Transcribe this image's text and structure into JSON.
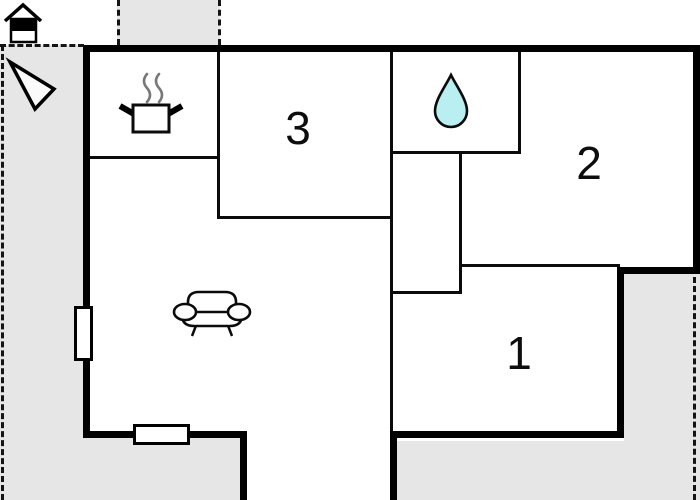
{
  "title": "Holiday home floor plan",
  "rooms": {
    "room1": {
      "label": "1"
    },
    "room2": {
      "label": "2"
    },
    "room3": {
      "label": "3"
    }
  },
  "areas": {
    "kitchen": "cooking-pot",
    "bathroom": "water-drop",
    "living_room": "sofa",
    "outdoor": "gray-terrace"
  },
  "icons": {
    "house": "house-icon",
    "north_arrow": "north-arrow-icon",
    "cooking_pot": "cooking-pot-icon",
    "water_drop": "water-drop-icon",
    "sofa": "sofa-icon"
  },
  "colors": {
    "ground": "#e6e6e6",
    "wall": "#000000",
    "water_drop_fill": "#b9eff1",
    "steam": "#787878"
  }
}
